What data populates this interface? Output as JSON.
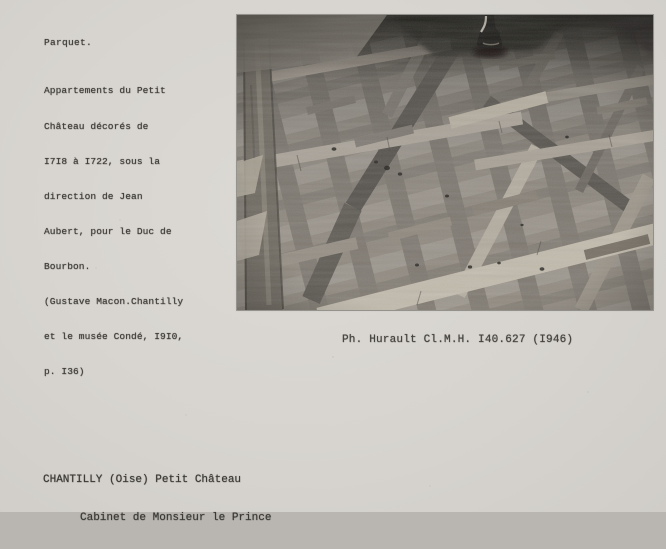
{
  "card": {
    "background": "#d7d4cf",
    "ink_color": "#3f3d39",
    "heading": "Parquet.",
    "description_lines": [
      "Appartements du Petit",
      "Château décorés de",
      "I7I8 à I722, sous la",
      "direction de Jean",
      "Aubert, pour le Duc de",
      "Bourbon.",
      "(Gustave Macon.Chantilly",
      "et le musée Condé, I9I0,",
      "p. I36)"
    ],
    "photo_caption": "Ph. Hurault Cl.M.H. I40.627 (I946)",
    "location_line_1": "CHANTILLY (Oise) Petit Château",
    "location_line_2": "Cabinet de Monsieur le Prince"
  },
  "photo": {
    "subject": "Versailles-pattern oak parquet floor seen at an oblique angle, turned furniture foot at top centre",
    "tone_base": "#8a857e",
    "tone_highlight": "#c2bbad",
    "tone_shadow": "#26241f"
  }
}
